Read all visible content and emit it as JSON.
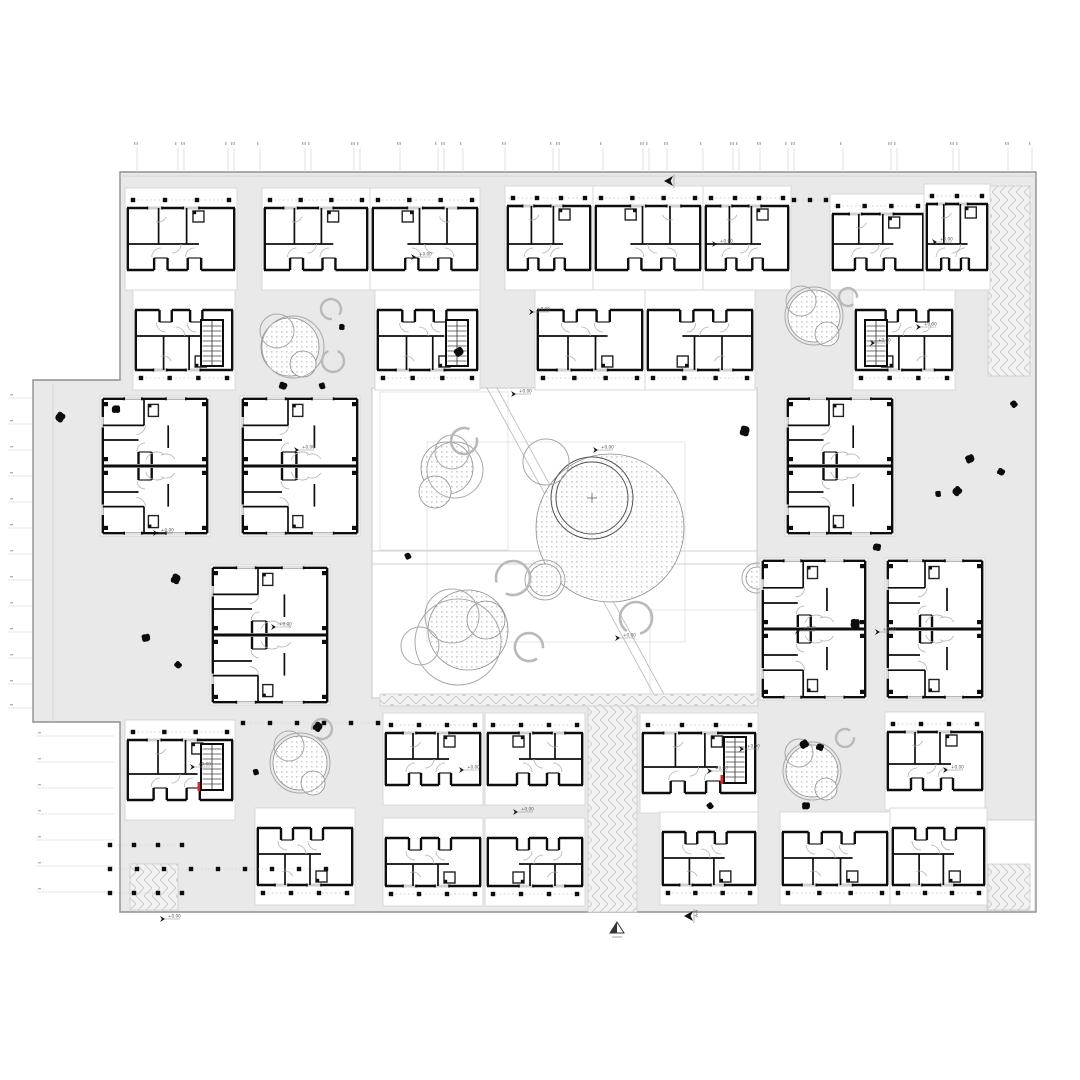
{
  "title": "residential-block-floor-plan",
  "palette": {
    "paper": "#ffffff",
    "plaza_fill": "#e9e9e9",
    "plaza_edge": "#8f8f8f",
    "block_fill": "#ffffff",
    "block_edge": "#d6d6d6",
    "wall": "#0d0d0d",
    "thin": "#9a9a9a",
    "lighter": "#c6c6c6",
    "hatch_line": "#c9c9c9",
    "hatch_fill": "#f2f2f2",
    "stipple_dot": "#9a9a9a",
    "tree_ring": "#a8a8a8",
    "tree_ring_dark": "#555555",
    "bench": "#b9b9b9",
    "accent_red": "#e02424",
    "label": "#555555"
  },
  "annotations": {
    "level_label": "+0.00",
    "section_label": "A-A"
  },
  "plaza": {
    "outline": [
      [
        120,
        172
      ],
      [
        1036,
        172
      ],
      [
        1036,
        912
      ],
      [
        120,
        912
      ],
      [
        120,
        722
      ],
      [
        33,
        722
      ],
      [
        33,
        380
      ],
      [
        120,
        380
      ]
    ],
    "notch": [
      987,
      820,
      48,
      91
    ],
    "inner_left_line": [
      53,
      383,
      53,
      722
    ],
    "inner_top_line": [
      120,
      176,
      1036,
      176
    ]
  },
  "courtyard": {
    "rect": [
      372,
      388,
      385,
      310
    ],
    "inner_rects": [
      [
        427,
        442,
        258,
        200
      ],
      [
        650,
        610,
        107,
        88
      ],
      [
        380,
        392,
        128,
        158
      ]
    ],
    "walk_y": [
      551,
      564
    ],
    "diagonal": [
      [
        487,
        388,
        657,
        700
      ],
      [
        497,
        388,
        667,
        700
      ]
    ],
    "cross": [
      592,
      498
    ]
  },
  "court_trees": {
    "stipple": [
      [
        447,
        468,
        26
      ],
      [
        435,
        492,
        16
      ],
      [
        610,
        528,
        74
      ],
      [
        545,
        580,
        16
      ],
      [
        468,
        630,
        40
      ],
      [
        486,
        620,
        19
      ],
      [
        757,
        578,
        11
      ]
    ],
    "rings": [
      [
        452,
        452,
        17
      ],
      [
        455,
        470,
        28
      ],
      [
        592,
        498,
        41
      ],
      [
        592,
        498,
        36
      ],
      [
        546,
        462,
        23
      ],
      [
        545,
        580,
        20
      ],
      [
        757,
        578,
        15
      ],
      [
        458,
        642,
        43
      ],
      [
        452,
        616,
        27
      ],
      [
        420,
        646,
        19
      ]
    ],
    "benches": [
      [
        464,
        441,
        13,
        -40
      ],
      [
        513,
        578,
        17,
        140
      ],
      [
        529,
        647,
        14,
        30
      ],
      [
        636,
        618,
        16,
        100
      ]
    ]
  },
  "plaza_trees": {
    "stipple": [
      [
        290,
        347,
        29
      ],
      [
        303,
        364,
        13
      ],
      [
        814,
        316,
        26
      ],
      [
        827,
        334,
        12
      ],
      [
        300,
        763,
        27
      ],
      [
        313,
        783,
        12
      ],
      [
        812,
        771,
        26
      ],
      [
        826,
        789,
        11
      ]
    ],
    "rings": [
      [
        277,
        331,
        17
      ],
      [
        293,
        347,
        31
      ],
      [
        801,
        301,
        15
      ],
      [
        814,
        316,
        29
      ],
      [
        289,
        746,
        15
      ],
      [
        300,
        763,
        30
      ],
      [
        799,
        753,
        14
      ],
      [
        812,
        771,
        29
      ]
    ],
    "benches": [
      [
        331,
        309,
        10,
        60
      ],
      [
        333,
        361,
        11,
        -90
      ],
      [
        848,
        297,
        9,
        30
      ],
      [
        322,
        729,
        10,
        150
      ],
      [
        845,
        738,
        9,
        -30
      ]
    ]
  },
  "hatches": [
    {
      "r": [
        988,
        186,
        42,
        190
      ],
      "v": 1
    },
    {
      "r": [
        130,
        864,
        48,
        46
      ],
      "v": 1
    },
    {
      "r": [
        380,
        694,
        378,
        12
      ],
      "v": 0
    },
    {
      "r": [
        588,
        706,
        49,
        206
      ],
      "v": 1
    },
    {
      "r": [
        988,
        864,
        42,
        46
      ],
      "v": 1
    }
  ],
  "blocks": [
    {
      "r": [
        125,
        188,
        112,
        102
      ],
      "t": "unit"
    },
    {
      "r": [
        262,
        188,
        108,
        102
      ],
      "t": "unit"
    },
    {
      "r": [
        370,
        188,
        110,
        102
      ],
      "t": "unit",
      "fx": 1
    },
    {
      "r": [
        505,
        186,
        88,
        104
      ],
      "t": "unit"
    },
    {
      "r": [
        593,
        186,
        110,
        104
      ],
      "t": "unit",
      "fx": 1
    },
    {
      "r": [
        703,
        186,
        88,
        104
      ],
      "t": "unit"
    },
    {
      "r": [
        830,
        194,
        96,
        96
      ],
      "t": "unit"
    },
    {
      "r": [
        924,
        184,
        66,
        106
      ],
      "t": "unit"
    },
    {
      "r": [
        133,
        290,
        102,
        100
      ],
      "t": "stair",
      "fy": 1
    },
    {
      "r": [
        375,
        290,
        105,
        100
      ],
      "t": "stair",
      "fy": 1
    },
    {
      "r": [
        535,
        290,
        110,
        100
      ],
      "t": "unit",
      "fy": 1
    },
    {
      "r": [
        645,
        290,
        110,
        100
      ],
      "t": "unit",
      "fx": 1,
      "fy": 1
    },
    {
      "r": [
        853,
        290,
        102,
        100
      ],
      "t": "stair",
      "fx": 1,
      "fy": 1
    },
    {
      "r": [
        100,
        396,
        110,
        140
      ],
      "t": "pair"
    },
    {
      "r": [
        240,
        396,
        120,
        140
      ],
      "t": "pair"
    },
    {
      "r": [
        785,
        396,
        110,
        140
      ],
      "t": "pair"
    },
    {
      "r": [
        210,
        565,
        120,
        140
      ],
      "t": "pair"
    },
    {
      "r": [
        760,
        558,
        108,
        142
      ],
      "t": "pair"
    },
    {
      "r": [
        885,
        558,
        100,
        142
      ],
      "t": "pair"
    },
    {
      "r": [
        125,
        720,
        110,
        100
      ],
      "t": "stair",
      "red": 1
    },
    {
      "r": [
        255,
        808,
        100,
        97
      ],
      "t": "unit",
      "fy": 1
    },
    {
      "r": [
        383,
        713,
        100,
        92
      ],
      "t": "unit"
    },
    {
      "r": [
        485,
        713,
        100,
        92
      ],
      "t": "unit",
      "fx": 1
    },
    {
      "r": [
        383,
        818,
        100,
        88
      ],
      "t": "unit",
      "fy": 1
    },
    {
      "r": [
        485,
        818,
        100,
        88
      ],
      "t": "unit",
      "fx": 1,
      "fy": 1
    },
    {
      "r": [
        640,
        713,
        118,
        100
      ],
      "t": "stair",
      "red": 1
    },
    {
      "r": [
        660,
        812,
        98,
        93
      ],
      "t": "unit",
      "fy": 1
    },
    {
      "r": [
        780,
        812,
        110,
        93
      ],
      "t": "unit",
      "fy": 1
    },
    {
      "r": [
        885,
        712,
        100,
        98
      ],
      "t": "unit"
    },
    {
      "r": [
        890,
        808,
        97,
        97
      ],
      "t": "unit",
      "fy": 1
    }
  ],
  "dot_rows": [
    {
      "y": 723,
      "x1": 243,
      "x2": 378,
      "s": 27
    },
    {
      "y": 845,
      "x1": 110,
      "x2": 182,
      "s": 24
    },
    {
      "y": 869,
      "x1": 110,
      "x2": 326,
      "s": 27
    },
    {
      "y": 893,
      "x1": 110,
      "x2": 182,
      "s": 24
    },
    {
      "y": 200,
      "x1": 794,
      "x2": 826,
      "s": 16
    }
  ],
  "bushes": [
    [
      342,
      327
    ],
    [
      459,
      352
    ],
    [
      283,
      386
    ],
    [
      322,
      386
    ],
    [
      60,
      417
    ],
    [
      116,
      409
    ],
    [
      1014,
      404
    ],
    [
      745,
      431
    ],
    [
      970,
      459
    ],
    [
      1001,
      472
    ],
    [
      938,
      494
    ],
    [
      957,
      491
    ],
    [
      877,
      547
    ],
    [
      408,
      556
    ],
    [
      176,
      579
    ],
    [
      146,
      638
    ],
    [
      178,
      665
    ],
    [
      855,
      624
    ],
    [
      804,
      744
    ],
    [
      820,
      747
    ],
    [
      256,
      772
    ],
    [
      318,
      727
    ],
    [
      806,
      806
    ],
    [
      710,
      806
    ]
  ],
  "ticks": {
    "top_x": [
      137,
      178,
      184,
      228,
      234,
      260,
      305,
      311,
      354,
      360,
      400,
      438,
      444,
      463,
      505,
      553,
      559,
      603,
      643,
      649,
      667,
      703,
      733,
      739,
      760,
      788,
      794,
      843,
      891,
      897,
      953,
      959,
      1008,
      1032
    ],
    "top_y1": 148,
    "top_y2": 172,
    "left_upper_y": [
      398,
      424,
      450,
      476,
      502,
      528,
      554,
      580,
      606,
      632,
      658,
      684,
      708
    ],
    "left_upper_x": [
      8,
      32
    ],
    "left_lower_y": [
      736,
      762,
      788,
      814,
      840,
      866,
      892
    ],
    "left_lower_x": [
      36,
      114
    ]
  },
  "level_markers": [
    [
      158,
      533
    ],
    [
      299,
      450
    ],
    [
      598,
      450
    ],
    [
      875,
      343
    ],
    [
      937,
      242
    ],
    [
      717,
      244
    ],
    [
      416,
      257
    ],
    [
      534,
      312
    ],
    [
      921,
      327
    ],
    [
      516,
      394
    ],
    [
      744,
      749
    ],
    [
      195,
      767
    ],
    [
      712,
      771
    ],
    [
      464,
      770
    ],
    [
      518,
      812
    ],
    [
      276,
      627
    ],
    [
      800,
      631
    ],
    [
      880,
      632
    ],
    [
      165,
      919
    ],
    [
      948,
      770
    ],
    [
      620,
      638
    ]
  ],
  "section_markers": [
    {
      "p": [
        668,
        181
      ],
      "label": 0
    },
    {
      "p": [
        688,
        916
      ],
      "label": 1
    }
  ],
  "north_arrow": [
    617,
    929
  ]
}
